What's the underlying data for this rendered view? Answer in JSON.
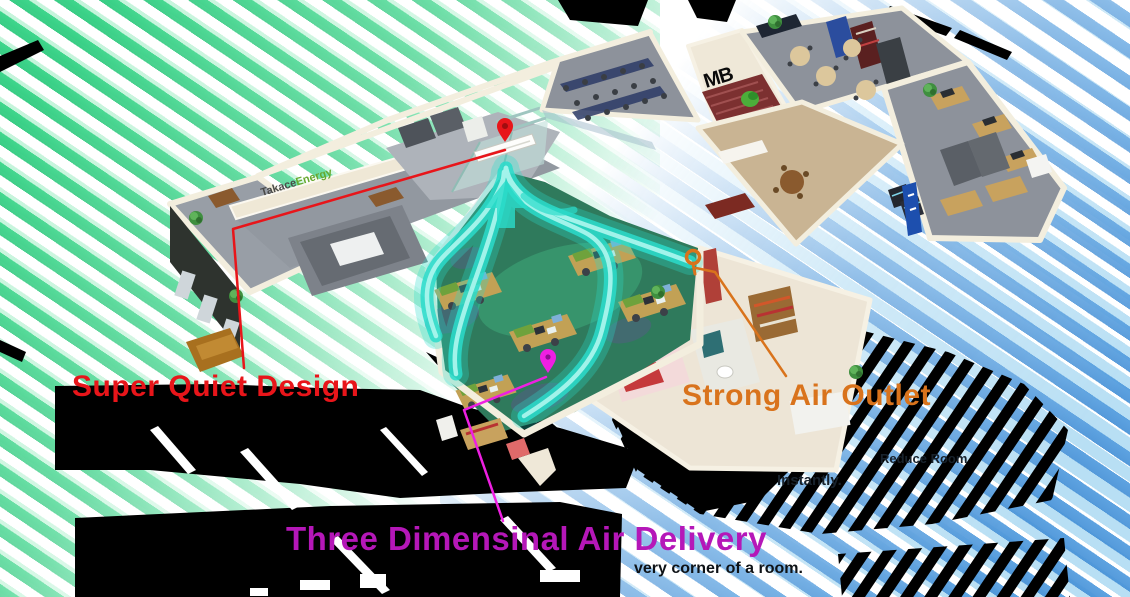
{
  "colors": {
    "red": "#e8151a",
    "orange": "#d9731c",
    "magenta": "#b517b8",
    "magenta_line": "#ee1fe2",
    "cyan": "#2bdccb",
    "stripe_green": "#2ecc7e",
    "stripe_blue": "#4a90d9"
  },
  "callouts": {
    "super_quiet": {
      "label": "Super Quiet Design"
    },
    "strong_air": {
      "label": "Strong Air Outlet"
    },
    "three_dimensional": {
      "label": "Three Dimensinal Air Delivery"
    }
  },
  "captions": {
    "strong_air_fragment_line1": "Reduce Room",
    "strong_air_fragment_line2": "Instantly.",
    "bottom_fragment": "very corner of a room."
  },
  "floorplan": {
    "wall_logo_first": "Takace",
    "wall_logo_second": "Energy",
    "stair_wall_logo": "MB"
  }
}
